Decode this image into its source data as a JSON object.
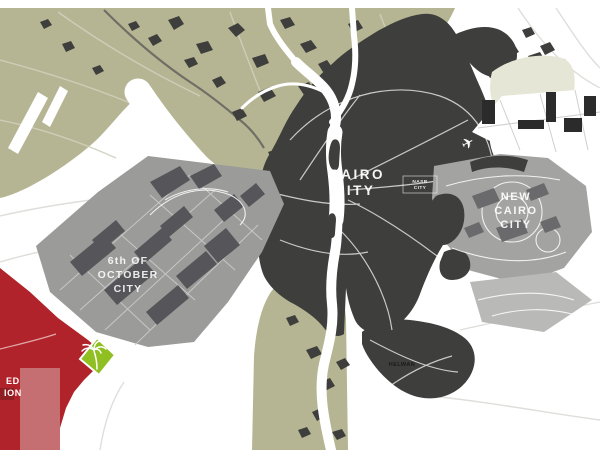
{
  "map": {
    "name": "Greater Cairo urban development map",
    "labels": {
      "cairo_city": [
        "CAIRO",
        "CITY"
      ],
      "nasr_city": [
        "NASR",
        "CITY"
      ],
      "new_cairo_city": [
        "NEW",
        "CAIRO",
        "CITY"
      ],
      "october_city": [
        "6th OF",
        "OCTOBER",
        "CITY"
      ],
      "helwan": "HELWAN",
      "proposed_clipped": [
        "ED",
        "ION"
      ]
    },
    "icons": {
      "airplane_glyph": "✈",
      "palm_logo": "palm-tree-logo"
    }
  },
  "colors": {
    "farmland": "#b6b593",
    "urban_dark": "#3e3e3c",
    "village_dark": "#3e3e3c",
    "october_gray": "#9b9b99",
    "october_block": "#55555а-fixed",
    "block_dark_gray": "#56565a",
    "new_cairo_gray": "#a3a3a1",
    "new_cairo_block": "#6a6a6c",
    "southeast_gray": "#b9b9b7",
    "beige": "#e6e6d6",
    "dev_block_black": "#2b2b2b",
    "proposal_red": "#b1232a",
    "proposal_red_light": "#c66f72",
    "proposal_red_dark": "#8f1d22",
    "logo_green": "#8fbf21",
    "river_white": "#ffffff",
    "dark_road": "#6f6f65"
  }
}
